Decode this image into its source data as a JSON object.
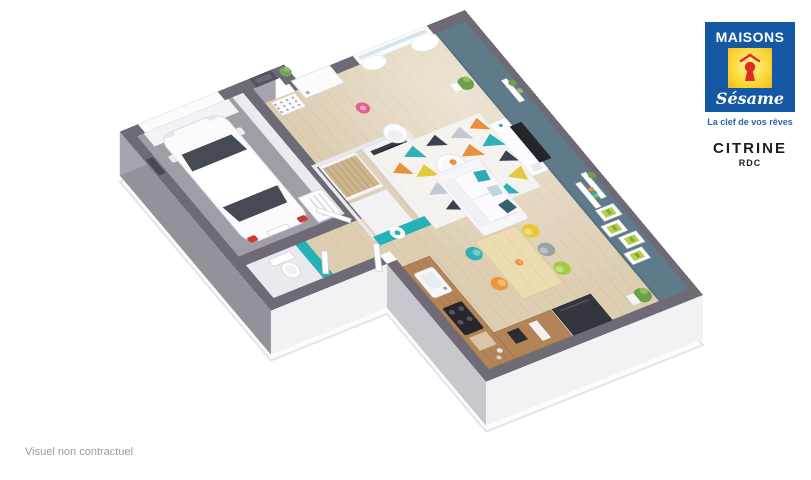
{
  "branding": {
    "logo_word_top": "MAISONS",
    "logo_word_script": "Sésame",
    "tagline": "La clef de vos rêves",
    "colors": {
      "blue": "#1558a4",
      "yellow": "#fcd735",
      "red": "#e02b20",
      "white": "#ffffff"
    }
  },
  "plan": {
    "model_name": "CITRINE",
    "level": "RDC"
  },
  "footer": {
    "disclaimer": "Visuel non contractuel"
  },
  "floorplan_scene": {
    "type": "isometric-3d-floor-plan-ground-floor",
    "colors": {
      "exterior_wall_top": "#6e6b77",
      "accent_wall_slate": "#5f7b8a",
      "accent_wall_teal": "#23b2b8",
      "wood_floor": "#ddceb2",
      "garage_floor": "#a09da6",
      "slab": "#fcfcfd",
      "rug_orange": "#e8913a",
      "rug_teal": "#2fb0b5",
      "rug_charcoal": "#3a4250",
      "rug_yellow": "#e3c93f"
    },
    "rooms": [
      {
        "name": "garage",
        "objects": [
          "white-car",
          "boiler",
          "garage-door"
        ]
      },
      {
        "name": "entrance-hall",
        "objects": [
          "front-door",
          "staircase",
          "open-wardrobe",
          "shoe-panel",
          "teal-wall-logo-stamp",
          "flue"
        ]
      },
      {
        "name": "wc",
        "objects": [
          "toilet",
          "teal-wall"
        ]
      },
      {
        "name": "living-dining-kitchen",
        "objects": [
          "window-curtains",
          "pink-floor-lamp",
          "white-armchair",
          "triangle-rug",
          "round-coffee-table",
          "white-sofa-teal-pillows",
          "tv-cabinet",
          "wall-shelves-plants",
          "green-art-frames",
          "corner-plant",
          "dining-table",
          "colored-chairs",
          "kitchen-counter",
          "hob",
          "sink",
          "fridge"
        ]
      }
    ],
    "dining_chair_colors": [
      "#2fb0b5",
      "#e6c833",
      "#9aa0a6",
      "#a5c93f",
      "#ec9733"
    ]
  }
}
